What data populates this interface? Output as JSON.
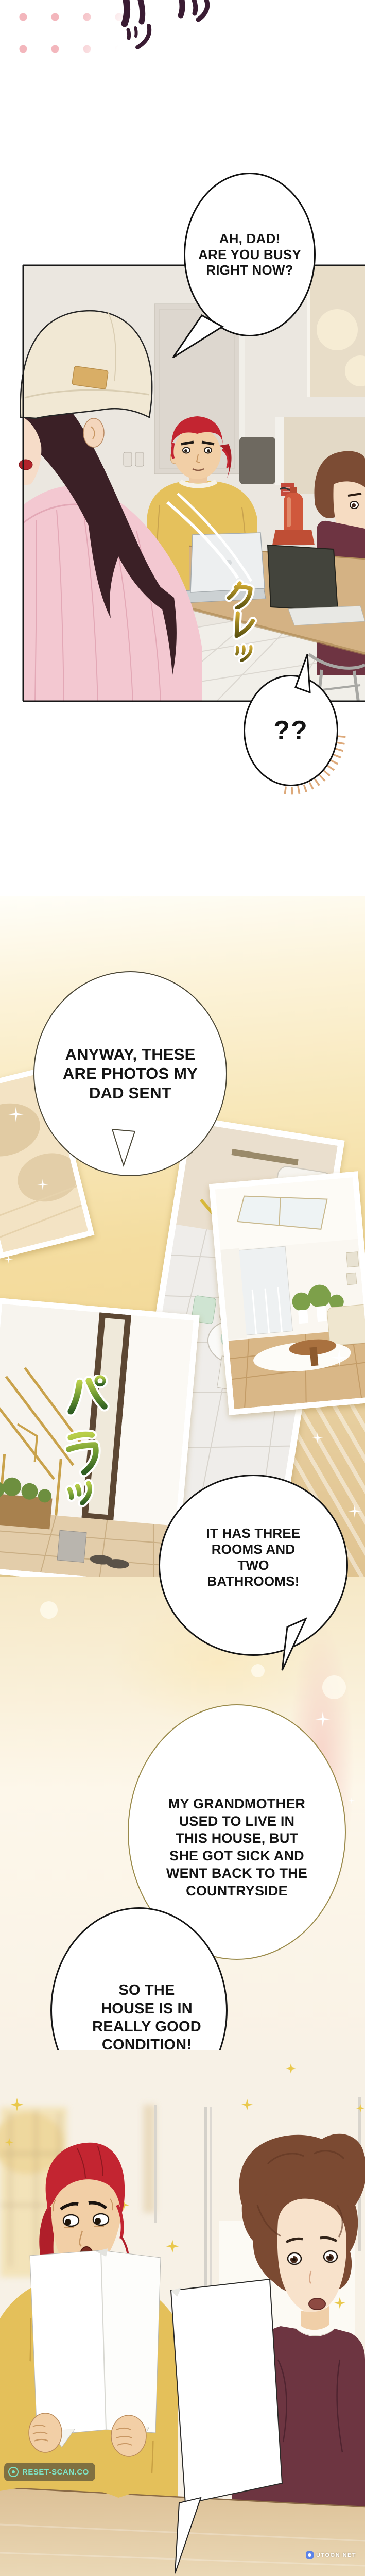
{
  "bubbles": {
    "b1": {
      "lines": [
        "AH, DAD!",
        "ARE YOU BUSY",
        "RIGHT NOW?"
      ]
    },
    "b2": {
      "text": "??"
    },
    "b3": {
      "lines": [
        "ANYWAY, THESE",
        "ARE PHOTOS MY",
        "DAD SENT"
      ]
    },
    "b4": {
      "lines": [
        "IT HAS THREE",
        "ROOMS AND",
        "TWO",
        "BATHROOMS!"
      ]
    },
    "b5": {
      "lines": [
        "MY GRANDMOTHER",
        "USED TO LIVE IN",
        "THIS HOUSE, BUT",
        "SHE GOT SICK AND",
        "WENT BACK TO THE",
        "COUNTRYSIDE"
      ]
    },
    "b6": {
      "lines": [
        "SO THE",
        "HOUSE IS IN",
        "REALLY GOOD",
        "CONDITION!"
      ]
    }
  },
  "sfx": {
    "top": {
      "label": "ツツ"
    },
    "kure": {
      "label": "クレッ"
    },
    "para": {
      "label": "パラッ"
    }
  },
  "watermarks": {
    "left": {
      "text": "RESET-SCAN.CO"
    },
    "right": {
      "text": "UTOON NET"
    }
  },
  "colors": {
    "sfx_plum": "#3a1c33",
    "sfx_gold": "#c8a336",
    "sfx_green": "#6f9a33",
    "watermark_teal": "#7de5c8",
    "photo_bg_gold": "#f2d794",
    "sweater_pink": "#f3c8d1",
    "shirt_yellow": "#e4c05a",
    "shirt_maroon": "#6d3541",
    "hair_red": "#c32531",
    "hair_brown": "#7b4a32"
  }
}
